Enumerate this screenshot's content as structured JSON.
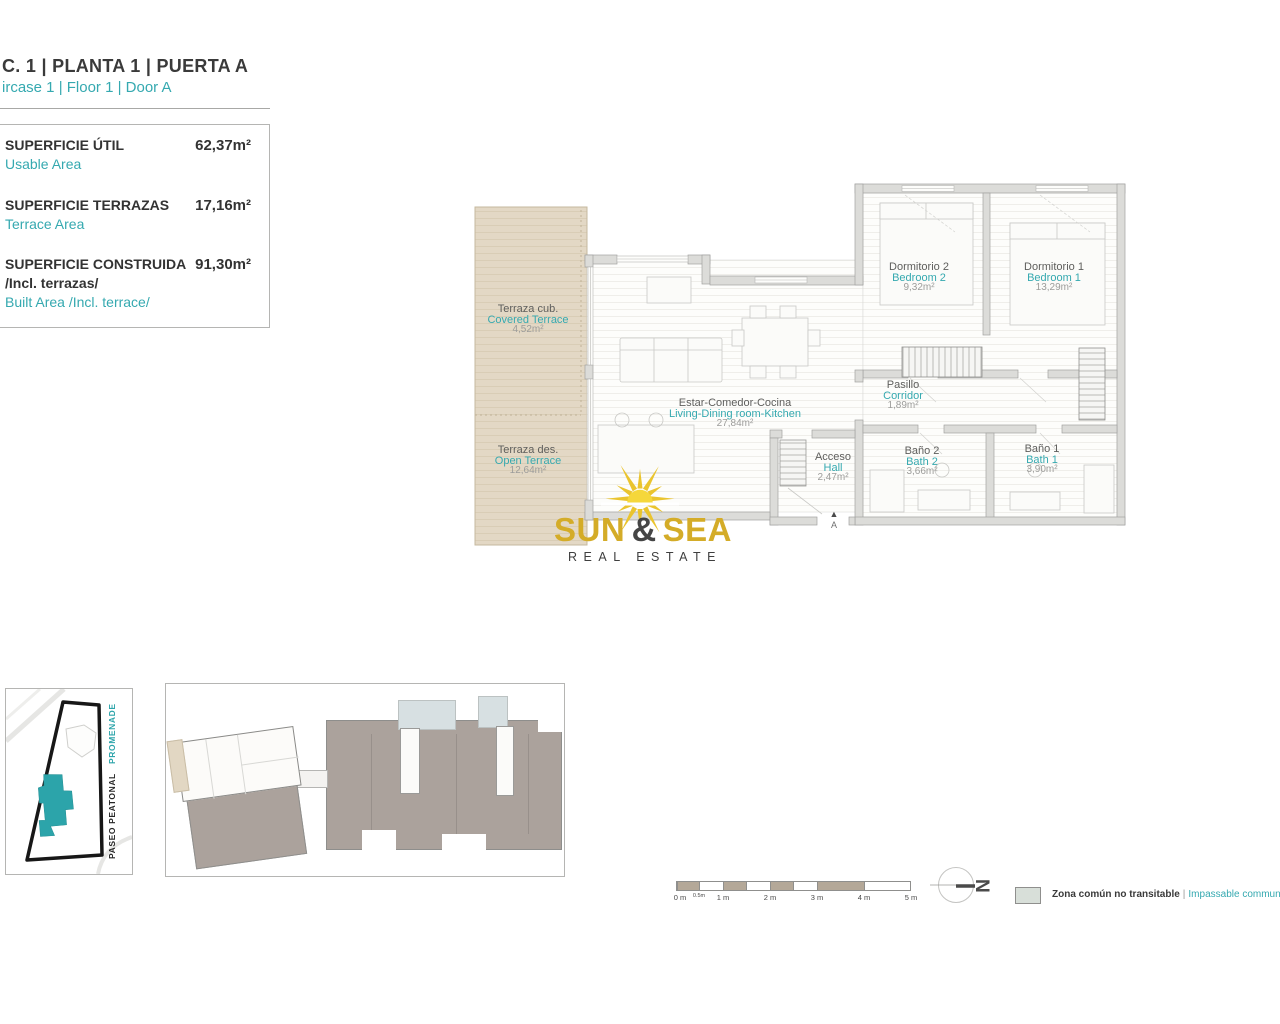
{
  "header": {
    "title": "C. 1 | PLANTA 1 | PUERTA A",
    "subtitle": "ircase 1 | Floor 1 | Door A"
  },
  "summary": {
    "rows": [
      {
        "label_es": "SUPERFICIE ÚTIL",
        "label_en": "Usable Area",
        "value": "62,37m²"
      },
      {
        "label_es": "SUPERFICIE TERRAZAS",
        "label_en": "Terrace Area",
        "value": "17,16m²"
      },
      {
        "label_es": "SUPERFICIE CONSTRUIDA",
        "label_es_extra": "/Incl. terrazas/",
        "label_en": "Built Area /Incl. terrace/",
        "value": "91,30m²"
      }
    ]
  },
  "plan": {
    "rooms": [
      {
        "name_es": "Terraza cub.",
        "name_en": "Covered Terrace",
        "area": "4,52m²"
      },
      {
        "name_es": "Terraza des.",
        "name_en": "Open Terrace",
        "area": "12,64m²"
      },
      {
        "name_es": "Estar-Comedor-Cocina",
        "name_en": "Living-Dining room-Kitchen",
        "area": "27,84m²"
      },
      {
        "name_es": "Dormitorio 2",
        "name_en": "Bedroom 2",
        "area": "9,32m²"
      },
      {
        "name_es": "Dormitorio 1",
        "name_en": "Bedroom 1",
        "area": "13,29m²"
      },
      {
        "name_es": "Pasillo",
        "name_en": "Corridor",
        "area": "1,89m²"
      },
      {
        "name_es": "Baño 2",
        "name_en": "Bath 2",
        "area": "3,66m²"
      },
      {
        "name_es": "Baño 1",
        "name_en": "Bath 1",
        "area": "3,90m²"
      },
      {
        "name_es": "Acceso",
        "name_en": "Hall",
        "area": "2,47m²"
      }
    ],
    "entrance_label": "A"
  },
  "logo": {
    "word1": "SUN",
    "ampersand": "&",
    "word2": "SEA",
    "tagline": "REAL ESTATE"
  },
  "site_map": {
    "street_en": "PROMENADE",
    "street_es": "PASEO PEATONAL"
  },
  "scale_bar": {
    "labels": [
      "0 m",
      "0.5m",
      "1 m",
      "2 m",
      "3 m",
      "4 m",
      "5 m"
    ]
  },
  "compass": {
    "north_label": "N"
  },
  "legend": {
    "label_es": "Zona común no transitable",
    "separator": "|",
    "label_en": "Impassable communal area"
  },
  "colors": {
    "accent_teal": "#2fa7ae",
    "logo_gold": "#d4ac28",
    "terrace_beige": "#e3d8c5",
    "wall_gray": "#dcdcd9",
    "building_teal": "#2ca4aa",
    "unit_gray": "#aba29c",
    "legend_swatch": "#d8dfd9",
    "scale_fill": "#b4a898"
  }
}
